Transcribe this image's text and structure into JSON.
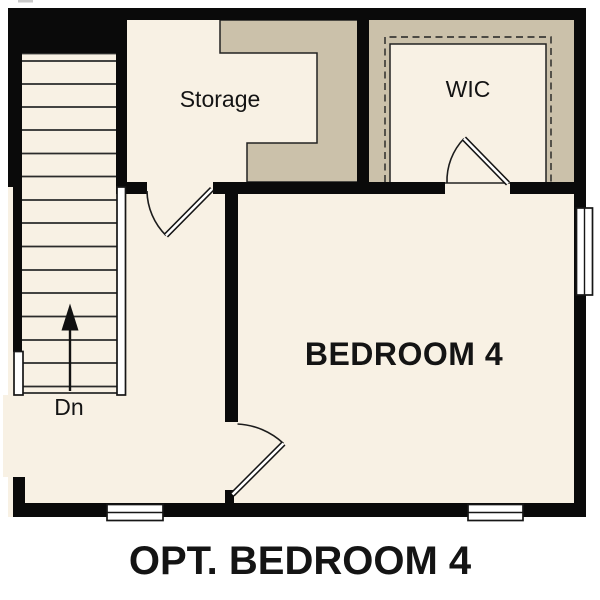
{
  "title": "OPT. BEDROOM 4",
  "rooms": [
    {
      "id": "storage",
      "label": "Storage"
    },
    {
      "id": "wic",
      "label": "WIC"
    },
    {
      "id": "bedroom-4",
      "label": "BEDROOM 4"
    }
  ],
  "stairs": {
    "direction_label": "Dn",
    "arrow": "up"
  },
  "symbols": {
    "doors": [
      "storage-door",
      "wic-door",
      "bedroom-4-door"
    ],
    "windows": [
      "right-wall-window",
      "bottom-left-window",
      "bottom-right-window"
    ]
  },
  "colors": {
    "page": "#ffffff",
    "floor": "#f8f1e4",
    "millwork": "#cbc1aa",
    "wall": "#0a0a0a",
    "line": "#222222",
    "text": "#141414"
  }
}
